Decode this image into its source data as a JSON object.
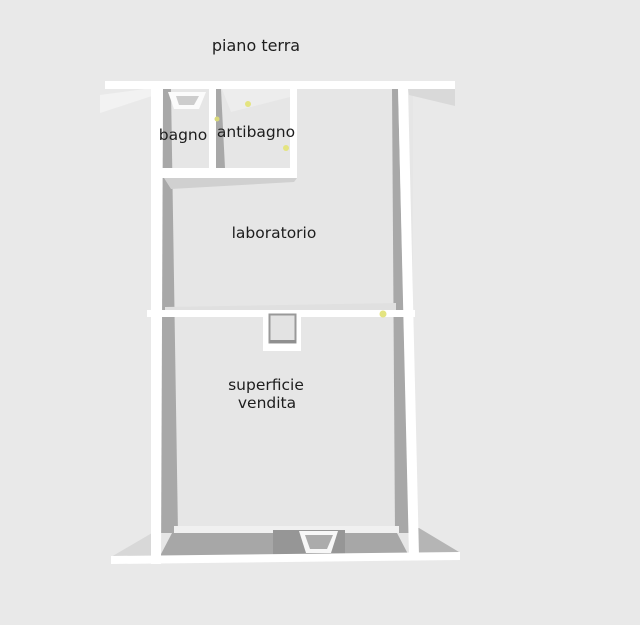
{
  "plan": {
    "title": "piano terra",
    "labels": {
      "bagno": "bagno",
      "antibagno": "antibagno",
      "laboratorio": "laboratorio",
      "superficie_line1": "superficie",
      "superficie_line2": "vendita"
    },
    "colors": {
      "background": "#e9e9e9",
      "floor": "#e6e6e6",
      "wall": "#ffffff",
      "wall_shadow": "#a8a8a8",
      "wall_face_light": "#d2d2d2",
      "marker_yellow": "#e4e480",
      "text": "#1d1d1d"
    }
  }
}
